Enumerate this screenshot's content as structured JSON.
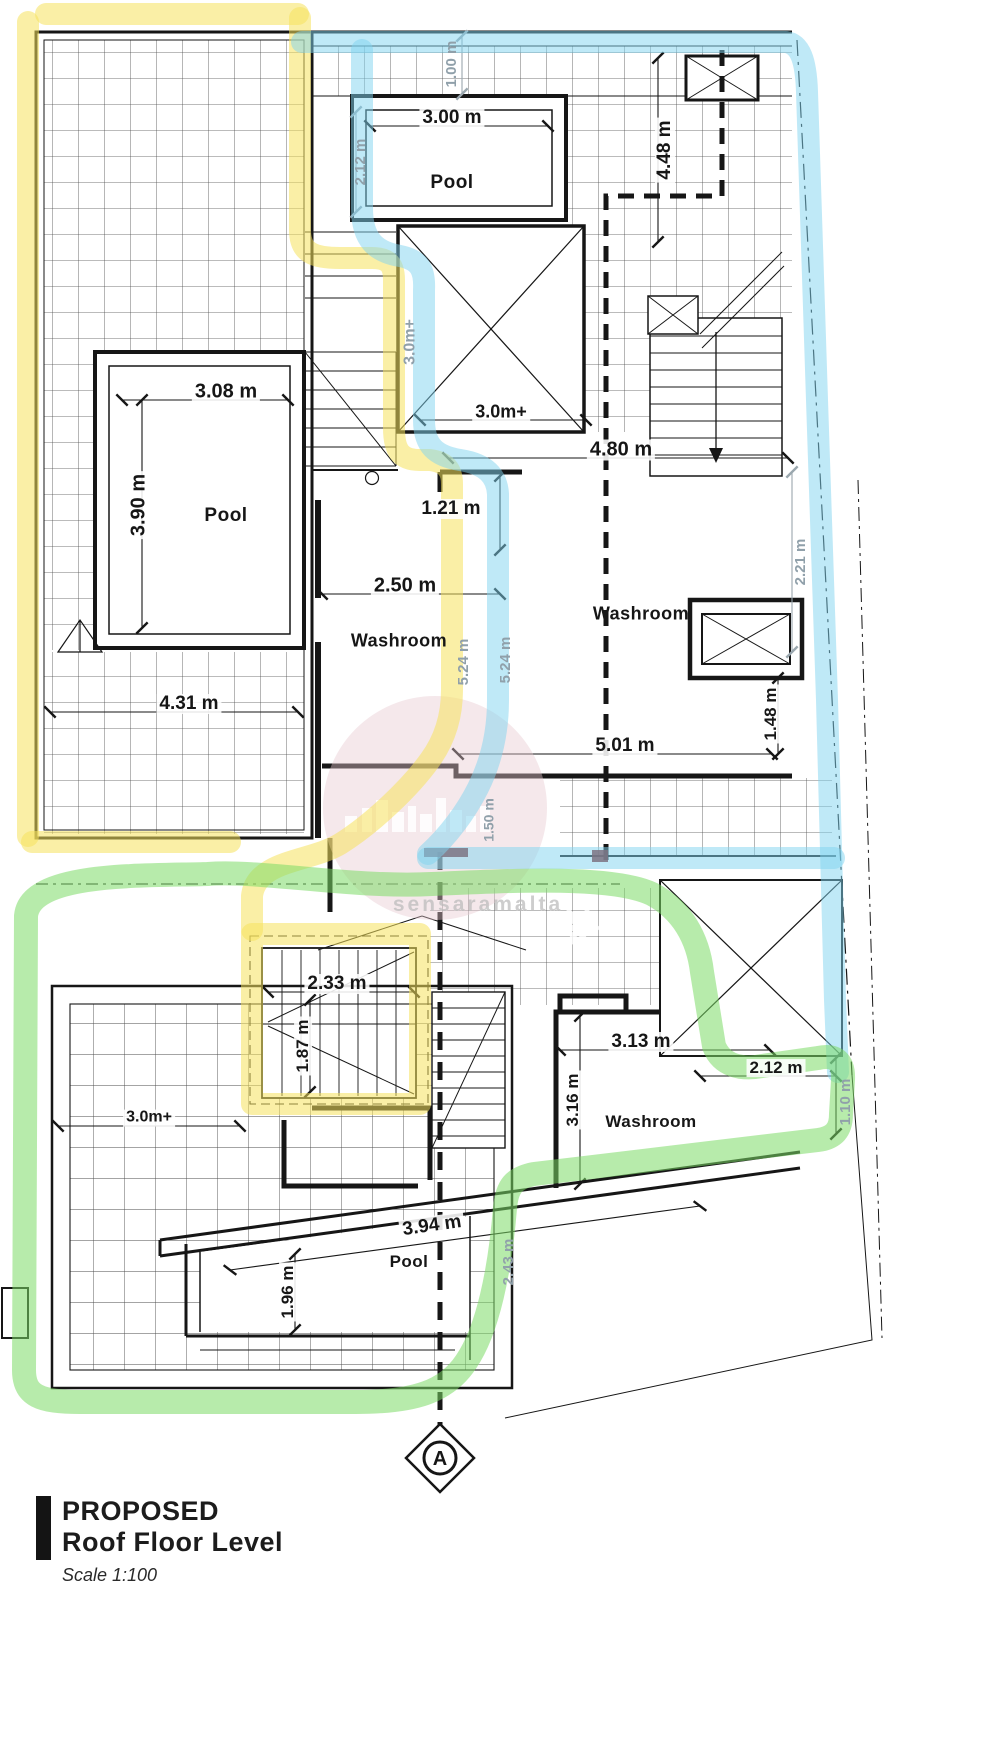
{
  "drawing": {
    "labels": {
      "dim_100": "1.00 m",
      "dim_300": "3.00 m",
      "pool_top": "Pool",
      "dim_212_top": "2.12 m",
      "dim_448": "4.48 m",
      "dim_308": "3.08 m",
      "dim_390": "3.90 m",
      "pool_left": "Pool",
      "dim_30m_vert": "3.0m+",
      "dim_30m_horiz": "3.0m+",
      "dim_121": "1.21 m",
      "dim_480": "4.80 m",
      "dim_250": "2.50 m",
      "washroom_left": "Washroom",
      "washroom_right": "Washroom",
      "dim_524_a": "5.24 m",
      "dim_524_b": "5.24 m",
      "dim_431": "4.31 m",
      "dim_221": "2.21 m",
      "dim_148": "1.48 m",
      "dim_501": "5.01 m",
      "dim_150": "1.50 m",
      "dim_233": "2.33 m",
      "dim_187": "1.87 m",
      "dim_30m_lower": "3.0m+",
      "dim_313": "3.13 m",
      "dim_316": "3.16 m",
      "washroom_lower": "Washroom",
      "dim_212_lower": "2.12 m",
      "dim_110": "1.10 m",
      "dim_394": "3.94 m",
      "dim_196": "1.96 m",
      "pool_bottom": "Pool",
      "dim_243": "2.43 m"
    },
    "section_marker": "A",
    "watermark": "sensaramalta",
    "highlight_colors": {
      "yellow": "#f6e25c",
      "blue": "#7fd4f0",
      "green": "#7cdb66"
    },
    "title_block": {
      "title": "PROPOSED",
      "subtitle": "Roof Floor Level",
      "scale": "Scale 1:100"
    }
  }
}
